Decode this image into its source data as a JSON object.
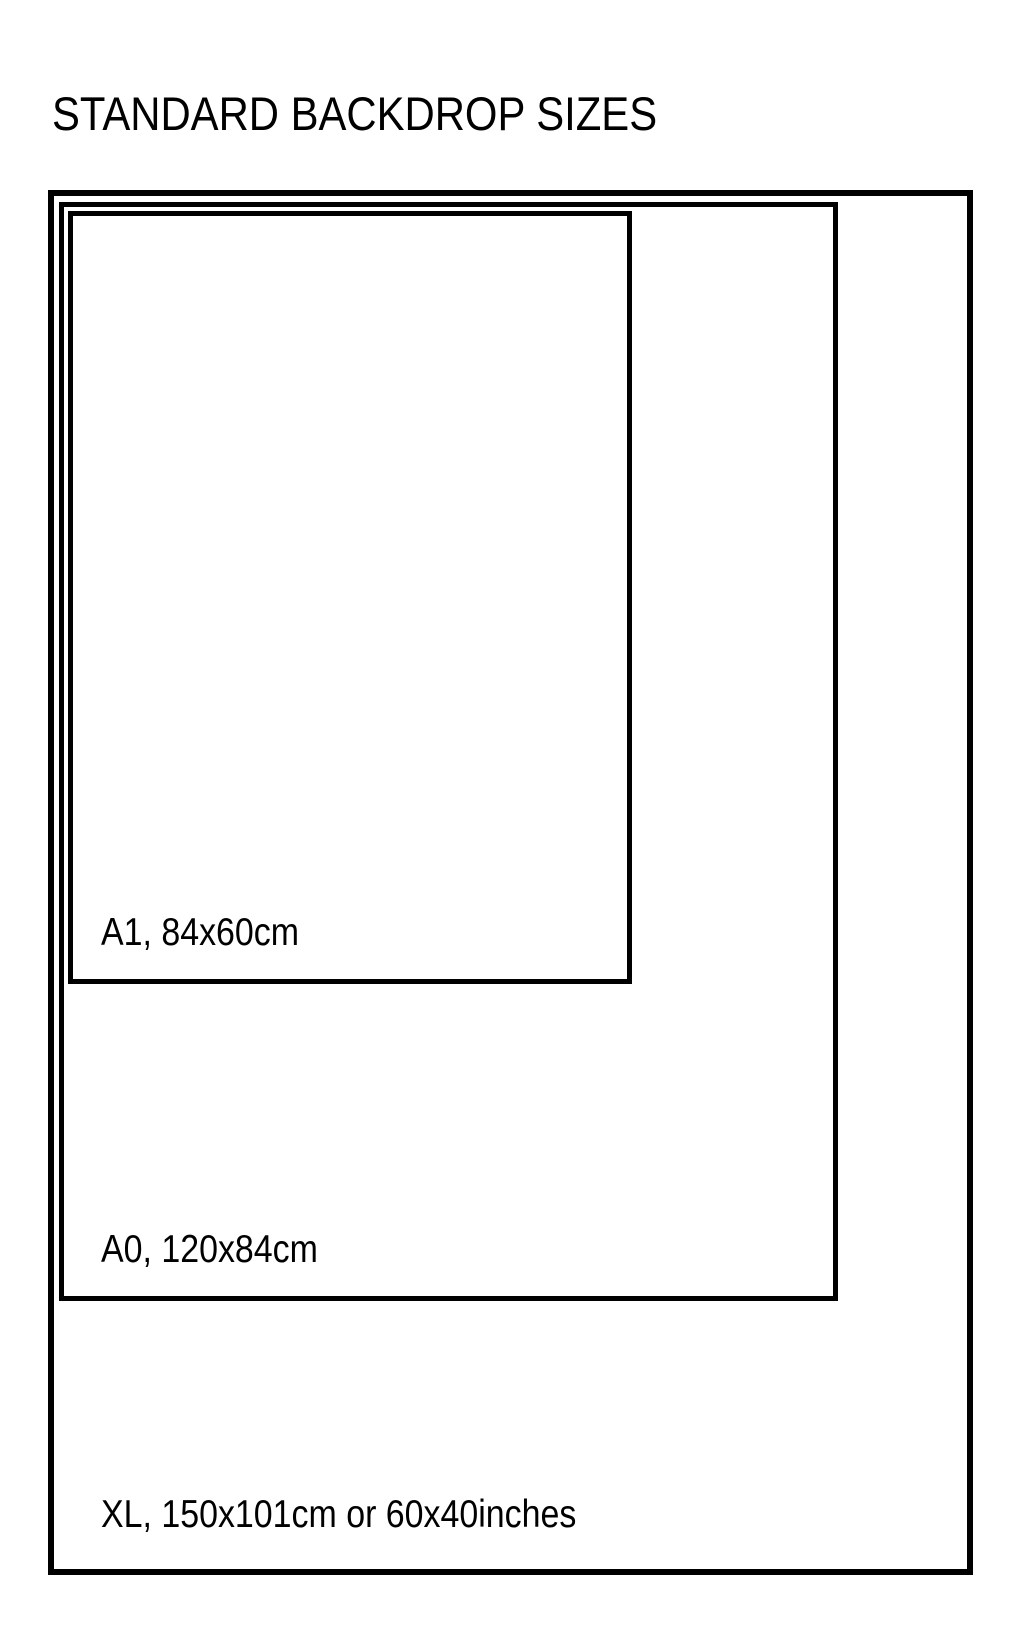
{
  "page": {
    "title": "STANDARD BACKDROP SIZES",
    "background_color": "#ffffff",
    "line_color": "#000000",
    "text_color": "#000000"
  },
  "sizes": [
    {
      "id": "a1",
      "label": "A1, 84x60cm",
      "name": "A1",
      "dimensions_cm": "84x60"
    },
    {
      "id": "a0",
      "label": "A0, 120x84cm",
      "name": "A0",
      "dimensions_cm": "120x84"
    },
    {
      "id": "xl",
      "label": "XL, 150x101cm or 60x40inches",
      "name": "XL",
      "dimensions_cm": "150x101",
      "dimensions_inches": "60x40"
    }
  ]
}
